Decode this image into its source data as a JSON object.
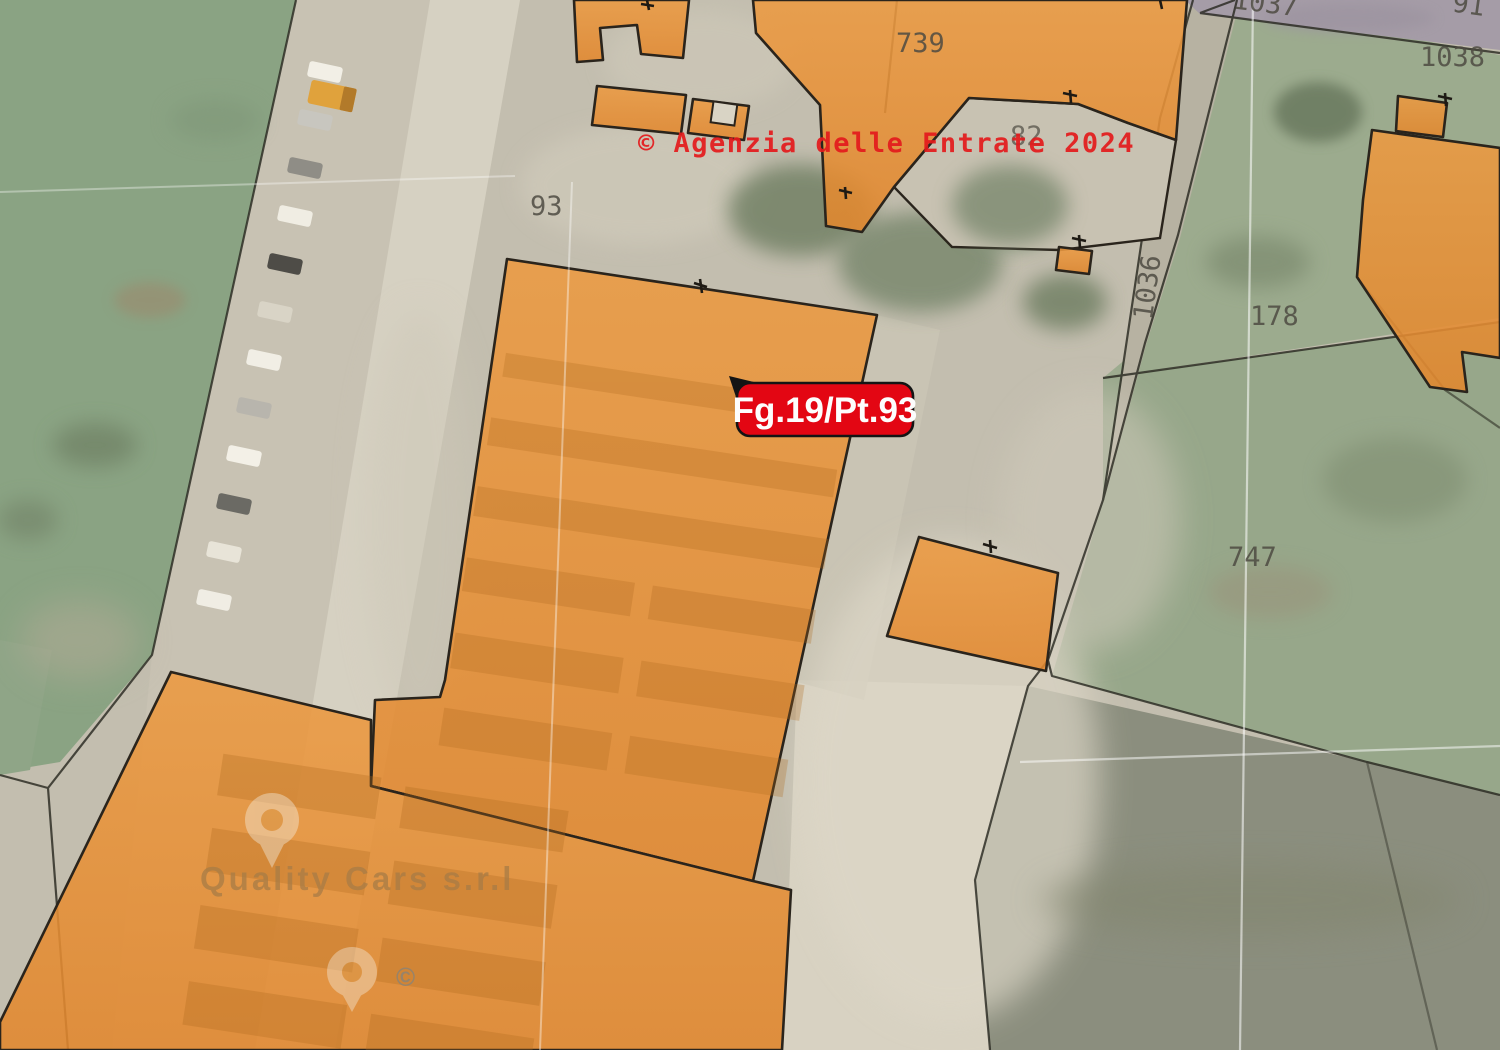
{
  "map": {
    "watermark_text": "© Agenzia delle Entrate 2024",
    "selection_label": "Fg.19/Pt.93",
    "business_label": "Quality Cars s.r.l",
    "copyright_mark": "©",
    "parcels": [
      {
        "id": "93"
      },
      {
        "id": "739"
      },
      {
        "id": "82"
      },
      {
        "id": "1036"
      },
      {
        "id": "178"
      },
      {
        "id": "747"
      },
      {
        "id": "1038"
      },
      {
        "id": "1037"
      },
      {
        "id": "91"
      }
    ],
    "colors": {
      "building_fill": "#e78f33",
      "building_outline": "#2a241c",
      "selection_red": "#e30613",
      "watermark_red": "#e41a1c",
      "grid_white": "#ffffff"
    }
  }
}
